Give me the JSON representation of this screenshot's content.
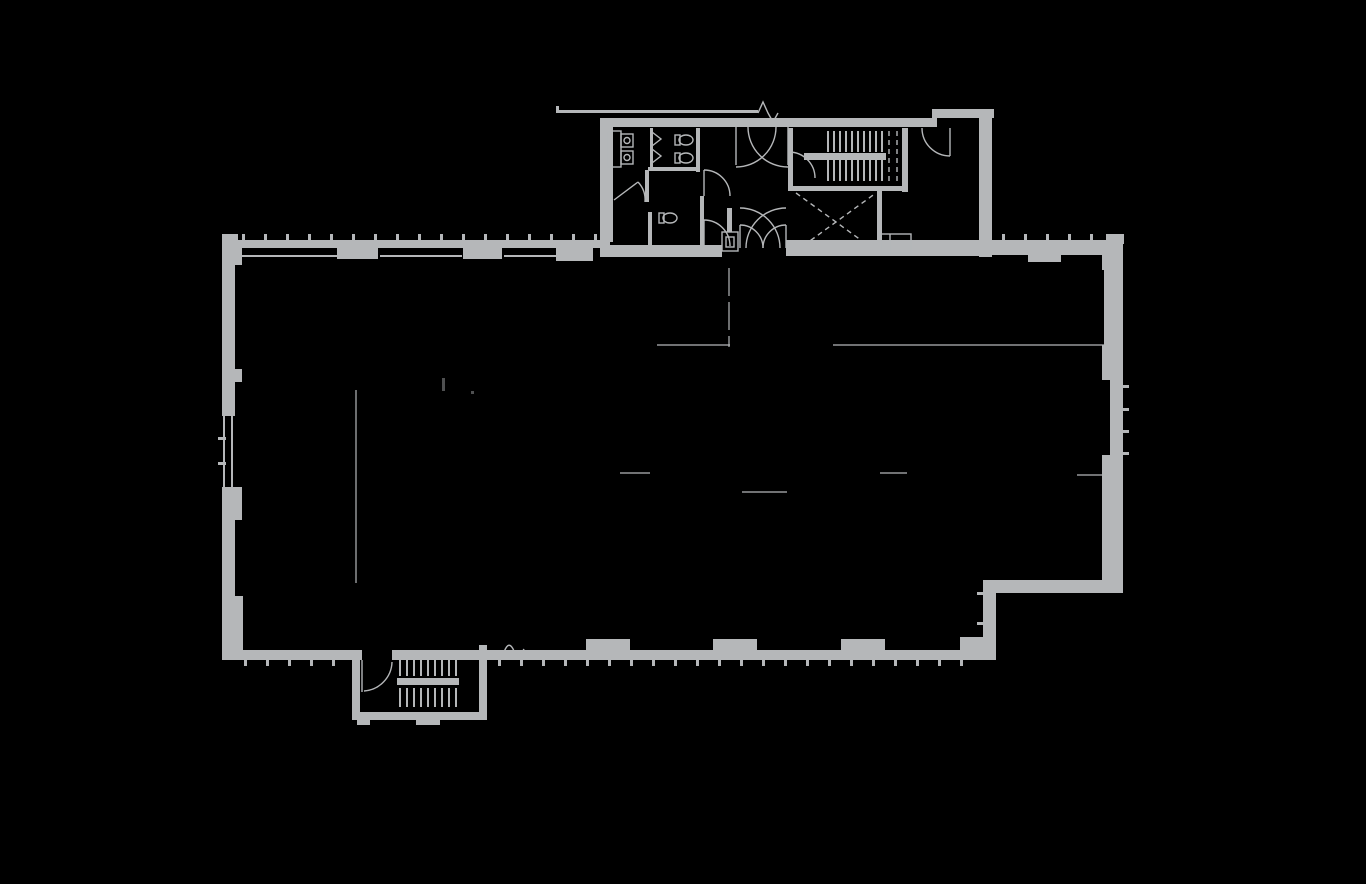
{
  "document": {
    "type": "architectural-floor-plan",
    "description": "Single-storey building floor plan drawn in light gray linework on a black background",
    "visible_text": [],
    "illegible_tiny_marks": 2,
    "break_line_symbols": 2
  },
  "colors": {
    "background": "#000000",
    "wall": "#b5b7b9",
    "faint": "#8f9193"
  },
  "plan": {
    "main_hall": {
      "label": "main open hall",
      "shape": "large rectangle with stepped southeast corner",
      "perimeter": "thick walls with interior pilasters and exterior window mullion ticks",
      "west_wall_feature": "double-line glazing segment with mullions"
    },
    "north_core": {
      "label": "north service core annex",
      "rooms": [
        {
          "label": "restroom",
          "fixtures": [
            "sink",
            "sink",
            "toilet-stall",
            "toilet-stall"
          ]
        },
        {
          "label": "single restroom",
          "fixtures": [
            "toilet"
          ]
        },
        {
          "label": "vestibule lobby",
          "features": [
            "double-door swing star",
            "double entry doors",
            "shaft box"
          ]
        },
        {
          "label": "stairwell",
          "features": [
            "two flights",
            "landing",
            "break dashes"
          ]
        },
        {
          "label": "elevator shaft",
          "features": [
            "dashed X mark",
            "small closet"
          ]
        },
        {
          "label": "east room",
          "features": [
            "single door swing"
          ]
        }
      ],
      "canopy_line": "thin roof/overhang line with lightning break symbol"
    },
    "south_stair": {
      "label": "south stair bump-out",
      "features": [
        "entry door swing",
        "two flights",
        "landing",
        "foundation tabs"
      ]
    },
    "interior": {
      "label": "faint interior layout lines",
      "features": [
        "long east-west partition line",
        "short wall stubs",
        "thin north-south line west side",
        "dashed corridor line below vestibule"
      ]
    },
    "fixture_counts": {
      "sinks": 2,
      "toilets": 3,
      "stair_flights": 4,
      "door_swings": 9,
      "elevator_x": 1
    }
  }
}
